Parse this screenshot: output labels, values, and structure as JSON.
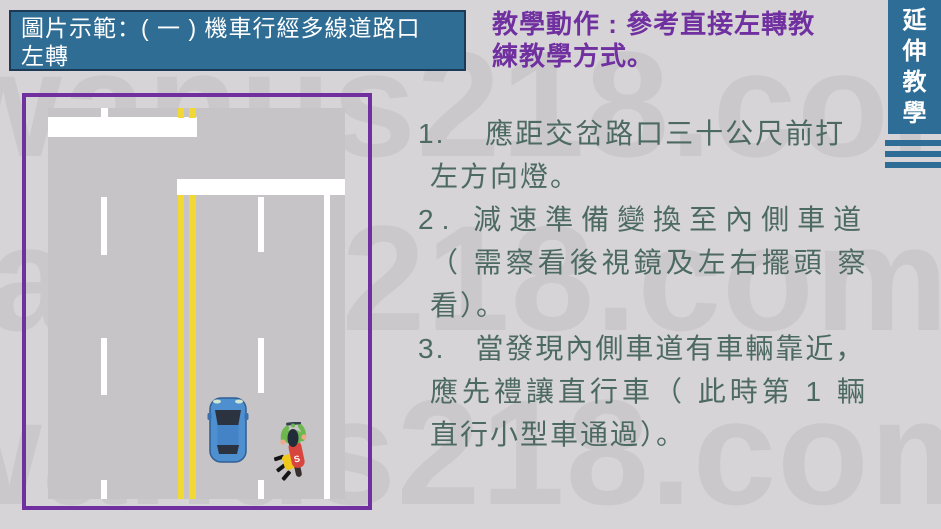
{
  "slide": {
    "background": "#D7D4D7"
  },
  "watermark": {
    "text": "wanus218.com"
  },
  "title_box": {
    "bg": "#2F6D94",
    "border": "#1C3A55",
    "text_color": "#FFFFFF",
    "lines": [
      "圖片示範：( 一 ) 機車行經多線道路口",
      "左轉"
    ]
  },
  "teaching_action": {
    "color": "#7030A0",
    "lines": [
      "教學動作 : 參考直接左轉教",
      "練教學方式。"
    ]
  },
  "steps": {
    "color": "#4D6A62",
    "items": [
      {
        "lines": [
          "1.　 應距交岔路口三十公尺前打",
          "左方向燈。"
        ]
      },
      {
        "lines": [
          "2. 減速準備變換至內側車道",
          "（ 需察看後視鏡及左右擺頭  察",
          "看）。"
        ]
      },
      {
        "lines": [
          "3.　當發現內側車道有車輛靠近，",
          "應先禮讓直行車（ 此時第 1 輛",
          "直行小型車通過）。"
        ]
      }
    ]
  },
  "side_tab": {
    "bg": "#2E6E96",
    "text_color": "#FFFFFF",
    "chars": [
      "延",
      "伸",
      "教",
      "學"
    ]
  },
  "diagram": {
    "border_color": "#7030A0",
    "road_color": "#C6C4C6",
    "marking_white": "#FFFFFF",
    "marking_yellow": "#F2D835",
    "car_color": "#4E8FD0",
    "scooter_badge": "S"
  }
}
